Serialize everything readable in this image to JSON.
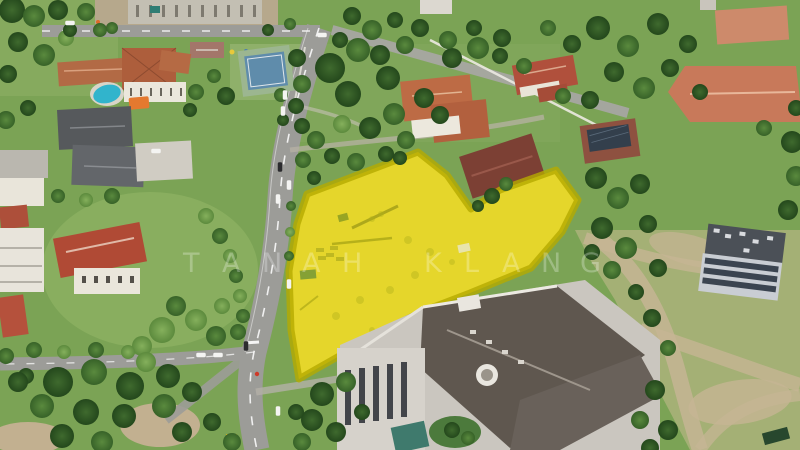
{
  "scene": {
    "description": "Aerial drone photo of a residential neighbourhood with a vacant construction plot highlighted in translucent yellow; roads, mansions with terracotta roofs, a swimming pool, a sports court, a large grey-roofed institutional building and an empty field are visible.",
    "overlay_label": "highlighted-land-plot"
  },
  "watermark": {
    "text": "TANAH KLANG",
    "y": 272,
    "font_size": 27,
    "color": "#ffffff",
    "opacity": 0.27,
    "letters": [
      {
        "ch": "T",
        "x": 183
      },
      {
        "ch": "A",
        "x": 222
      },
      {
        "ch": "N",
        "x": 262
      },
      {
        "ch": "A",
        "x": 302
      },
      {
        "ch": "H",
        "x": 342
      },
      {
        "ch": "K",
        "x": 424
      },
      {
        "ch": "L",
        "x": 464
      },
      {
        "ch": "A",
        "x": 502
      },
      {
        "ch": "N",
        "x": 541
      },
      {
        "ch": "G",
        "x": 580
      }
    ]
  },
  "overlay": {
    "points": "418,152 447,175 471,209 500,190 556,170 578,200 562,232 531,268 470,293 423,311 381,332 341,355 311,372 299,379 291,330 289,271 297,224 307,194",
    "fill": "#f2e400",
    "fill_opacity": 0.68,
    "stroke": "#b5aa00",
    "stroke_width": 7,
    "stroke_opacity": 0.8,
    "under_fill": "#c9b687"
  },
  "palette": {
    "grass_base": "#7ba355",
    "grass_light": "#8cb062",
    "field": "#a4b075",
    "road": "#9c9c98",
    "dirt": "#c2b090",
    "roof_red": "#b04a35",
    "roof_terracotta": "#ad5e3c",
    "roof_grey": "#56595c",
    "big_roof": "#5f574f",
    "pool_blue": "#31b4cc",
    "court_blue": "#5f8cab",
    "court_green": "#9cb690",
    "awning_orange": "#e4792f",
    "white_wall": "#eae6db",
    "tree_dark": "#2c5221",
    "tree_mid": "#447233",
    "tree_light": "#6e9b4a",
    "car_white": "#f4f4f2",
    "car_dark": "#2b2b2e",
    "bike_red": "#cf3a28"
  },
  "trees": [
    [
      12,
      10,
      13,
      0
    ],
    [
      34,
      16,
      11,
      1
    ],
    [
      58,
      10,
      10,
      0
    ],
    [
      86,
      12,
      9,
      1
    ],
    [
      18,
      42,
      10,
      0
    ],
    [
      44,
      55,
      11,
      1
    ],
    [
      8,
      74,
      9,
      0
    ],
    [
      66,
      38,
      8,
      2
    ],
    [
      100,
      30,
      7,
      1
    ],
    [
      6,
      120,
      9,
      1
    ],
    [
      28,
      108,
      8,
      0
    ],
    [
      196,
      92,
      8,
      1
    ],
    [
      226,
      96,
      9,
      0
    ],
    [
      214,
      76,
      7,
      1
    ],
    [
      190,
      110,
      7,
      0
    ],
    [
      297,
      58,
      9,
      0
    ],
    [
      302,
      84,
      9,
      1
    ],
    [
      296,
      106,
      8,
      0
    ],
    [
      281,
      95,
      7,
      1
    ],
    [
      283,
      120,
      6,
      0
    ],
    [
      330,
      68,
      15,
      0
    ],
    [
      358,
      50,
      12,
      1
    ],
    [
      348,
      94,
      13,
      0
    ],
    [
      388,
      78,
      12,
      0
    ],
    [
      394,
      114,
      11,
      1
    ],
    [
      424,
      98,
      10,
      0
    ],
    [
      370,
      128,
      11,
      0
    ],
    [
      406,
      140,
      9,
      1
    ],
    [
      342,
      124,
      9,
      2
    ],
    [
      316,
      140,
      9,
      1
    ],
    [
      302,
      126,
      8,
      0
    ],
    [
      440,
      115,
      9,
      0
    ],
    [
      380,
      55,
      10,
      0
    ],
    [
      405,
      45,
      9,
      1
    ],
    [
      303,
      160,
      8,
      1
    ],
    [
      314,
      178,
      7,
      0
    ],
    [
      332,
      156,
      8,
      0
    ],
    [
      356,
      162,
      9,
      1
    ],
    [
      386,
      154,
      8,
      0
    ],
    [
      400,
      158,
      7,
      0
    ],
    [
      452,
      58,
      10,
      0
    ],
    [
      478,
      48,
      11,
      1
    ],
    [
      502,
      38,
      9,
      0
    ],
    [
      548,
      28,
      8,
      1
    ],
    [
      572,
      44,
      9,
      0
    ],
    [
      598,
      28,
      12,
      0
    ],
    [
      628,
      46,
      11,
      1
    ],
    [
      658,
      24,
      11,
      0
    ],
    [
      688,
      44,
      9,
      0
    ],
    [
      614,
      72,
      10,
      0
    ],
    [
      644,
      88,
      11,
      1
    ],
    [
      670,
      68,
      9,
      0
    ],
    [
      700,
      92,
      8,
      0
    ],
    [
      590,
      100,
      9,
      0
    ],
    [
      563,
      96,
      8,
      1
    ],
    [
      420,
      28,
      9,
      0
    ],
    [
      448,
      40,
      9,
      1
    ],
    [
      474,
      28,
      8,
      0
    ],
    [
      500,
      56,
      8,
      0
    ],
    [
      524,
      66,
      8,
      1
    ],
    [
      492,
      196,
      8,
      0
    ],
    [
      506,
      184,
      7,
      1
    ],
    [
      478,
      206,
      6,
      0
    ],
    [
      596,
      178,
      11,
      0
    ],
    [
      618,
      198,
      11,
      1
    ],
    [
      640,
      184,
      10,
      0
    ],
    [
      602,
      228,
      11,
      0
    ],
    [
      626,
      248,
      11,
      1
    ],
    [
      648,
      224,
      9,
      0
    ],
    [
      658,
      268,
      9,
      0
    ],
    [
      612,
      270,
      9,
      1
    ],
    [
      592,
      252,
      8,
      0
    ],
    [
      636,
      292,
      8,
      0
    ],
    [
      792,
      142,
      11,
      0
    ],
    [
      796,
      176,
      10,
      1
    ],
    [
      788,
      210,
      10,
      0
    ],
    [
      764,
      128,
      8,
      1
    ],
    [
      796,
      108,
      8,
      0
    ],
    [
      206,
      216,
      8,
      2
    ],
    [
      220,
      236,
      8,
      1
    ],
    [
      230,
      256,
      7,
      2
    ],
    [
      236,
      276,
      7,
      1
    ],
    [
      240,
      296,
      7,
      2
    ],
    [
      243,
      316,
      7,
      1
    ],
    [
      291,
      206,
      5,
      1
    ],
    [
      290,
      232,
      5,
      2
    ],
    [
      289,
      256,
      5,
      1
    ],
    [
      162,
      330,
      13,
      2
    ],
    [
      196,
      320,
      11,
      2
    ],
    [
      216,
      336,
      10,
      1
    ],
    [
      176,
      306,
      10,
      1
    ],
    [
      142,
      346,
      10,
      2
    ],
    [
      222,
      306,
      8,
      2
    ],
    [
      238,
      332,
      8,
      1
    ],
    [
      34,
      350,
      8,
      1
    ],
    [
      64,
      352,
      7,
      2
    ],
    [
      96,
      350,
      8,
      1
    ],
    [
      128,
      352,
      7,
      2
    ],
    [
      26,
      376,
      8,
      0
    ],
    [
      6,
      356,
      8,
      1
    ],
    [
      58,
      382,
      15,
      0
    ],
    [
      94,
      372,
      13,
      1
    ],
    [
      130,
      386,
      14,
      0
    ],
    [
      168,
      376,
      12,
      0
    ],
    [
      42,
      406,
      12,
      1
    ],
    [
      86,
      412,
      13,
      0
    ],
    [
      124,
      416,
      12,
      0
    ],
    [
      164,
      406,
      12,
      1
    ],
    [
      18,
      382,
      10,
      0
    ],
    [
      146,
      362,
      10,
      2
    ],
    [
      192,
      392,
      10,
      0
    ],
    [
      62,
      436,
      12,
      0
    ],
    [
      102,
      442,
      11,
      1
    ],
    [
      182,
      432,
      10,
      0
    ],
    [
      212,
      422,
      9,
      0
    ],
    [
      232,
      442,
      9,
      1
    ],
    [
      322,
      394,
      12,
      0
    ],
    [
      346,
      382,
      10,
      1
    ],
    [
      312,
      420,
      11,
      0
    ],
    [
      336,
      432,
      10,
      0
    ],
    [
      302,
      442,
      9,
      1
    ],
    [
      362,
      412,
      8,
      0
    ],
    [
      296,
      412,
      8,
      0
    ],
    [
      452,
      430,
      8,
      0
    ],
    [
      468,
      438,
      7,
      1
    ],
    [
      652,
      318,
      9,
      0
    ],
    [
      668,
      348,
      8,
      1
    ],
    [
      655,
      390,
      10,
      0
    ],
    [
      640,
      420,
      9,
      1
    ],
    [
      668,
      430,
      10,
      0
    ],
    [
      650,
      448,
      9,
      0
    ],
    [
      70,
      30,
      7,
      0
    ],
    [
      112,
      28,
      6,
      1
    ],
    [
      268,
      30,
      6,
      0
    ],
    [
      290,
      24,
      6,
      1
    ],
    [
      352,
      16,
      9,
      0
    ],
    [
      372,
      30,
      10,
      1
    ],
    [
      340,
      40,
      8,
      0
    ],
    [
      395,
      20,
      8,
      0
    ],
    [
      112,
      196,
      8,
      1
    ],
    [
      86,
      200,
      7,
      2
    ],
    [
      58,
      196,
      7,
      1
    ]
  ],
  "cars": [
    {
      "x": 285,
      "y": 95,
      "o": "v",
      "c": "w"
    },
    {
      "x": 283,
      "y": 111,
      "o": "v",
      "c": "w"
    },
    {
      "x": 280,
      "y": 167,
      "o": "v",
      "c": "d"
    },
    {
      "x": 289,
      "y": 185,
      "o": "v",
      "c": "w"
    },
    {
      "x": 278,
      "y": 199,
      "o": "v",
      "c": "w"
    },
    {
      "x": 246,
      "y": 346,
      "o": "v",
      "c": "d"
    },
    {
      "x": 278,
      "y": 411,
      "o": "v",
      "c": "w"
    },
    {
      "x": 289,
      "y": 284,
      "o": "v",
      "c": "w"
    },
    {
      "x": 201,
      "y": 355,
      "o": "h",
      "c": "w"
    },
    {
      "x": 218,
      "y": 355,
      "o": "h",
      "c": "w"
    },
    {
      "x": 322,
      "y": 35,
      "o": "h",
      "c": "w"
    },
    {
      "x": 70,
      "y": 23,
      "o": "h",
      "c": "w"
    },
    {
      "x": 156,
      "y": 151,
      "o": "h",
      "c": "w"
    },
    {
      "x": 257,
      "y": 374,
      "o": "r",
      "c": "r"
    }
  ]
}
